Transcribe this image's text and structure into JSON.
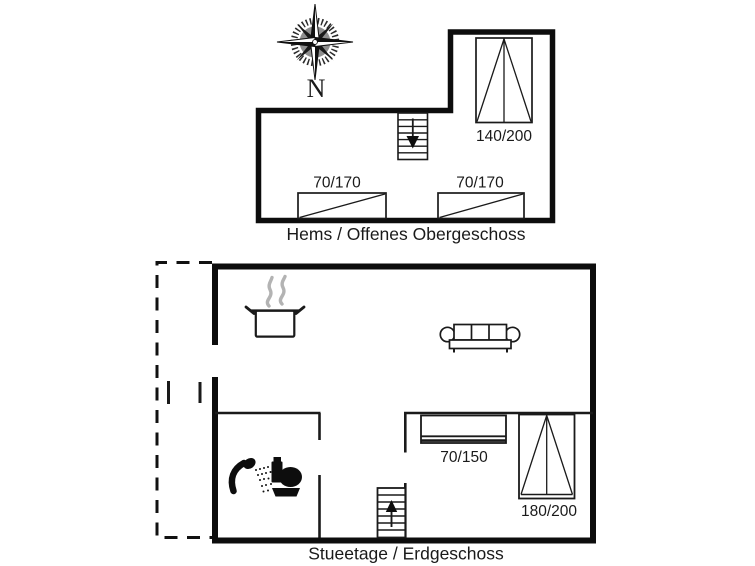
{
  "colors": {
    "ink": "#1a1a1a",
    "wall": "#0d0d0d",
    "steam_gray": "#b3b3b3",
    "background": "#ffffff"
  },
  "compass": {
    "north_label": "N"
  },
  "upper_floor": {
    "caption": "Hems / Offenes Obergeschoss",
    "double_bed": {
      "label": "140/200"
    },
    "single_beds": [
      {
        "label": "70/170"
      },
      {
        "label": "70/170"
      }
    ],
    "stairs": {
      "direction_icon": "arrow-down"
    }
  },
  "ground_floor": {
    "caption": "Stueetage / Erdgeschoss",
    "bunk_bed": {
      "label": "70/150"
    },
    "double_bed": {
      "label": "180/200"
    },
    "stairs": {
      "direction_icon": "arrow-up"
    },
    "feature_icons": [
      "terrace-dashed-outline",
      "door-opening-marks",
      "cooking-pot-icon",
      "steam-icon",
      "sofa-icon",
      "shower-icon",
      "toilet-icon"
    ]
  }
}
